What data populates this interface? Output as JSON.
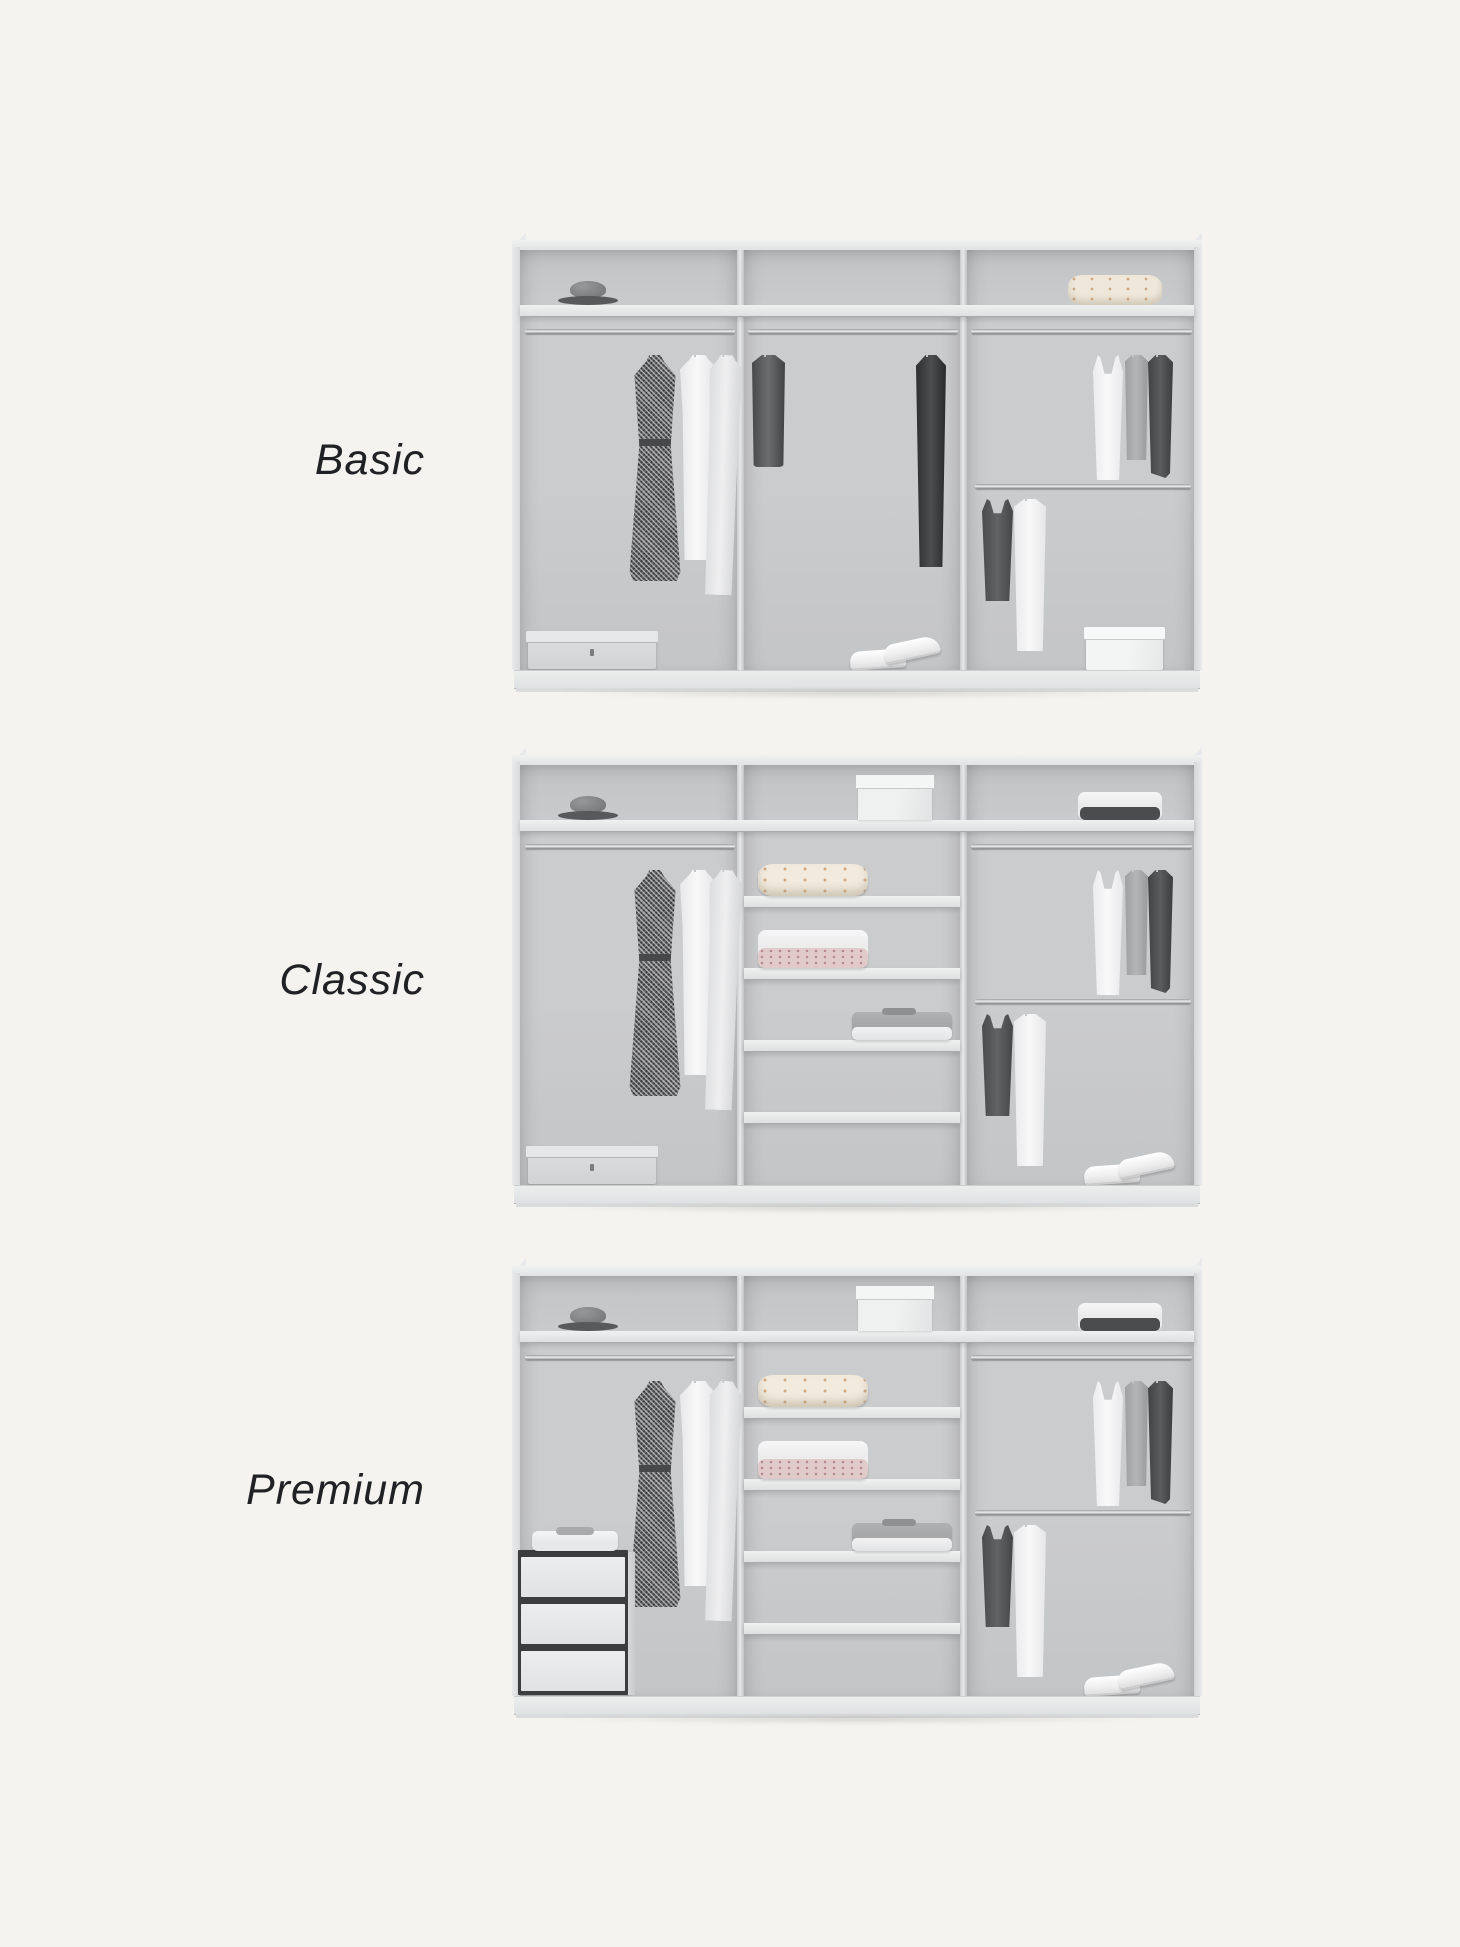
{
  "page": {
    "width": 1460,
    "height": 1947,
    "background_color": "#f4f3ef",
    "description": "Comparison illustration of three wardrobe interior equipment tiers"
  },
  "colors": {
    "label_text": "#202124",
    "wardrobe_frame": "#e9eaeb",
    "wardrobe_interior_back": "#c8c9cb",
    "shelf_board": "#e7e8e9",
    "rail_chrome": "#c0c1c3",
    "dark_garment": "#47484a",
    "light_garment": "#f2f2f3",
    "cream_knit": "#f1eadd"
  },
  "tiers": [
    {
      "id": "basic",
      "label": "Basic",
      "contents": {
        "left_section": {
          "top_shelf": [
            "hat"
          ],
          "rail": [
            "patterned-dress",
            "white-shirt",
            "light-coat"
          ],
          "floor": [
            "gray-storage-box"
          ]
        },
        "middle_section": {
          "top_shelf": [],
          "rail": [
            "dark-jacket",
            "black-coat"
          ],
          "floor": [
            "white-sneakers"
          ]
        },
        "right_section": {
          "top_shelf": [
            "folded-cream-sweater"
          ],
          "upper_rail": [
            "white-tank-top",
            "gray-shirt",
            "dark-shirt"
          ],
          "lower_rail": [
            "dark-tank-top",
            "long-white-shirt"
          ],
          "floor": [
            "white-storage-box"
          ]
        }
      }
    },
    {
      "id": "classic",
      "label": "Classic",
      "contents": {
        "left_section": {
          "top_shelf": [
            "hat"
          ],
          "rail": [
            "patterned-dress",
            "white-shirt",
            "light-coat"
          ],
          "floor": [
            "gray-storage-box"
          ]
        },
        "middle_section": {
          "top_shelf": [
            "white-box"
          ],
          "shelves": [
            "folded-cream-sweater",
            "white-and-rose-folded-stack",
            "gray-and-white-folded-stack"
          ],
          "floor": []
        },
        "right_section": {
          "top_shelf": [
            "white-and-dark-folded-stack"
          ],
          "upper_rail": [
            "white-tank-top",
            "gray-shirt",
            "dark-shirt"
          ],
          "lower_rail": [
            "dark-tank-top",
            "long-white-shirt"
          ],
          "floor": [
            "white-sneakers"
          ]
        }
      }
    },
    {
      "id": "premium",
      "label": "Premium",
      "contents": {
        "left_section": {
          "top_shelf": [
            "hat"
          ],
          "rail": [
            "patterned-dress",
            "white-shirt",
            "light-coat"
          ],
          "floor": [
            "three-drawer-unit",
            "folded-stack-on-drawers"
          ]
        },
        "middle_section": {
          "top_shelf": [
            "white-box"
          ],
          "shelves": [
            "folded-cream-sweater",
            "white-and-rose-folded-stack",
            "gray-and-white-folded-stack"
          ],
          "floor": []
        },
        "right_section": {
          "top_shelf": [
            "white-and-dark-folded-stack"
          ],
          "upper_rail": [
            "white-tank-top",
            "gray-shirt",
            "dark-shirt"
          ],
          "lower_rail": [
            "dark-tank-top",
            "long-white-shirt"
          ],
          "floor": [
            "white-sneakers"
          ]
        }
      }
    }
  ]
}
